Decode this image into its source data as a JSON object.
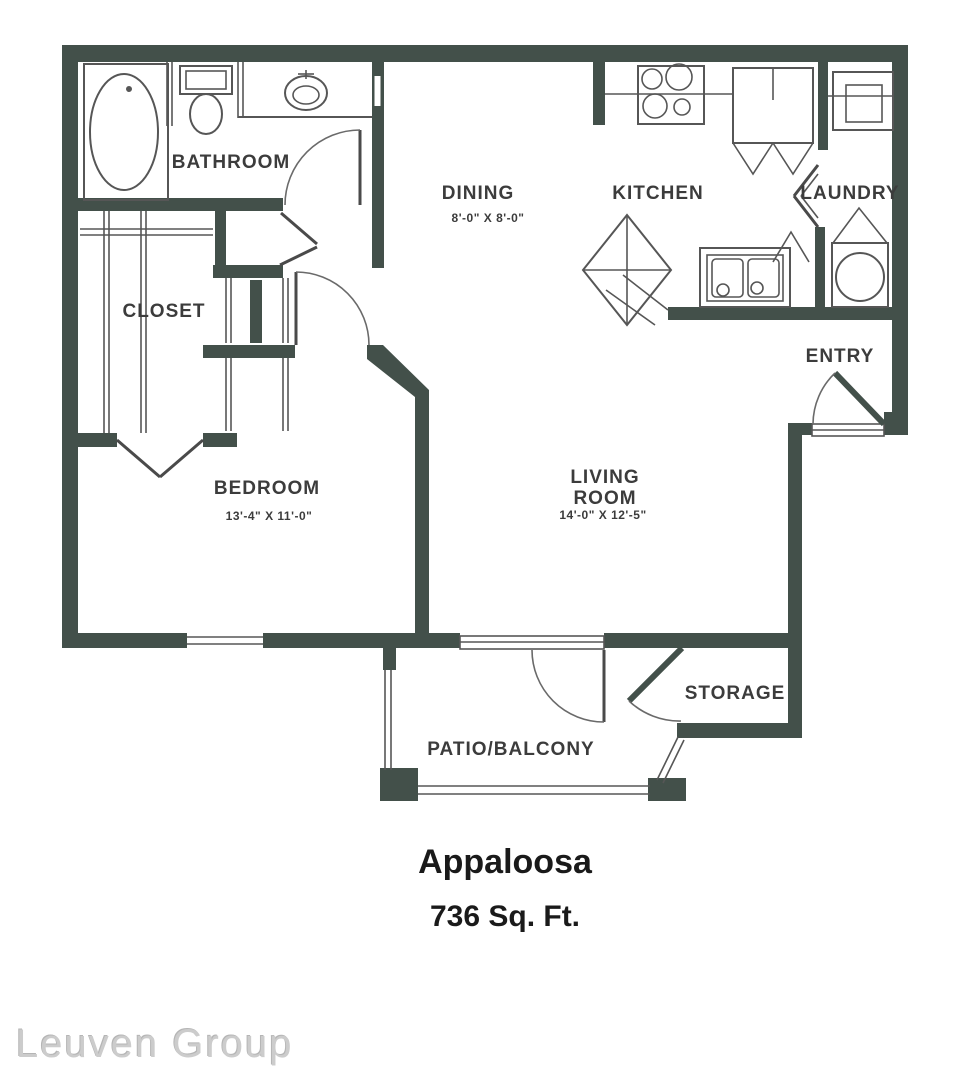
{
  "floorplan": {
    "name": "Appaloosa",
    "area": "736 Sq. Ft.",
    "watermark": "Leuven Group",
    "rooms": {
      "bathroom": {
        "label": "BATHROOM"
      },
      "closet": {
        "label": "CLOSET"
      },
      "dining": {
        "label": "DINING",
        "dims": "8'-0\" X 8'-0\""
      },
      "kitchen": {
        "label": "KITCHEN"
      },
      "laundry": {
        "label": "LAUNDRY"
      },
      "entry": {
        "label": "ENTRY"
      },
      "bedroom": {
        "label": "BEDROOM",
        "dims": "13'-4\" X 11'-0\""
      },
      "living_room": {
        "label_line1": "LIVING",
        "label_line2": "ROOM",
        "dims": "14'-0\" X 12'-5\""
      },
      "storage": {
        "label": "STORAGE"
      },
      "patio": {
        "label": "PATIO/BALCONY"
      }
    },
    "colors": {
      "wall": "#43504a",
      "line": "#565656",
      "label_text": "#3c3c3c",
      "title_text": "#1a1a1a",
      "watermark_text": "#cccccc"
    }
  }
}
